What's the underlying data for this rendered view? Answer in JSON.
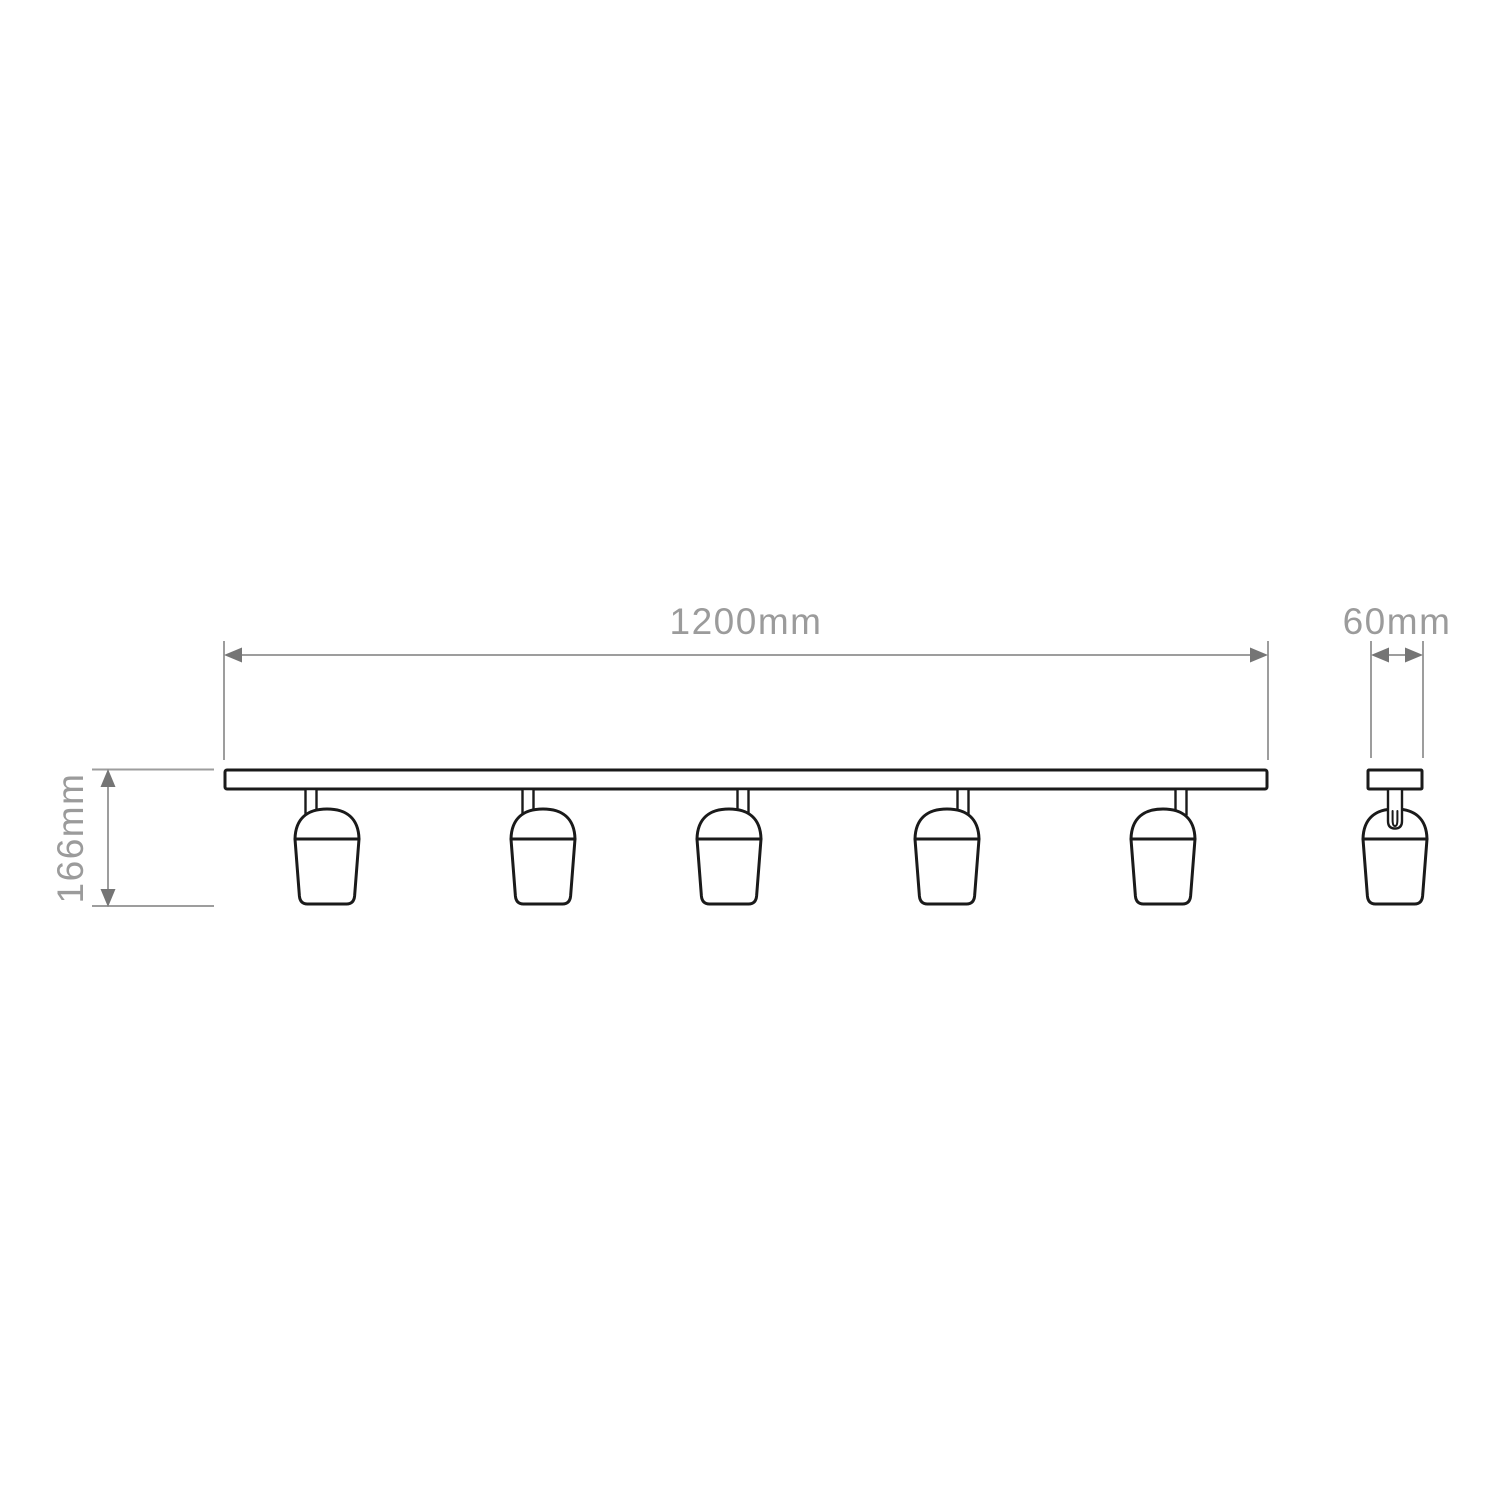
{
  "page": {
    "background": "#ffffff"
  },
  "drawing": {
    "kind": "product-dimension-diagram",
    "subject": "five-head ceiling spotlight track bar, front and side elevations",
    "front_view": {
      "spotlight_count": 5,
      "width_dimension": {
        "label": "1200mm",
        "value": 1200,
        "unit": "mm"
      },
      "height_dimension": {
        "label": "166mm",
        "value": 166,
        "unit": "mm"
      }
    },
    "side_view": {
      "depth_dimension": {
        "label": "60mm",
        "value": 60,
        "unit": "mm"
      }
    },
    "colors": {
      "dimension_line": "#9d9d9d",
      "dimension_text": "#9b9b9b",
      "arrowhead": "#757575",
      "fixture_outline": "#1a1a1a",
      "background": "#ffffff"
    }
  }
}
